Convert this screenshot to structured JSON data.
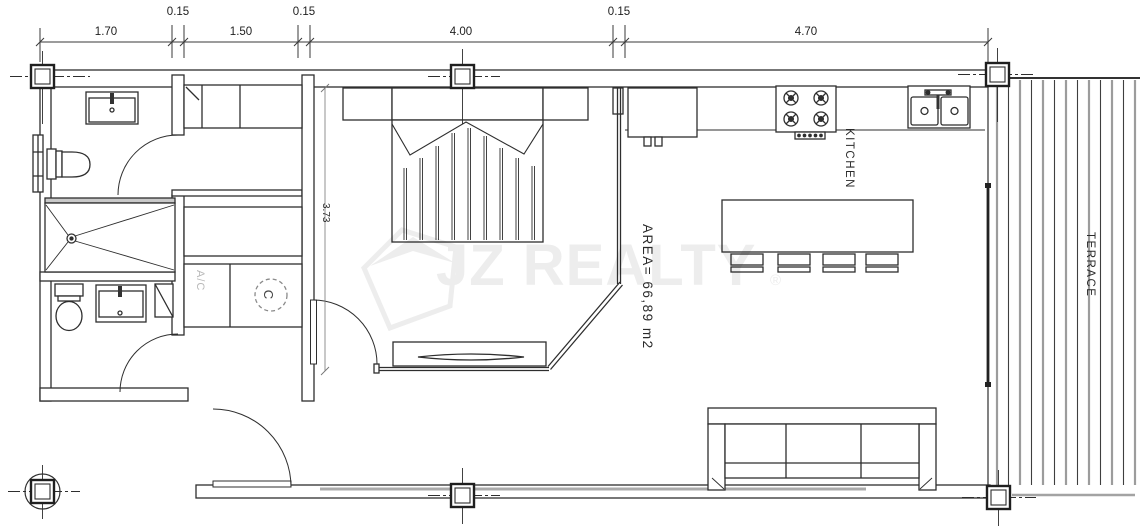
{
  "dims": {
    "top": [
      "1.70",
      "0.15",
      "1.50",
      "0.15",
      "4.00",
      "0.15",
      "4.70"
    ],
    "side": "3.73"
  },
  "labels": {
    "kitchen": "KITCHEN",
    "terrace": "TERRACE",
    "area": "AREA= 66,89  m2",
    "ac": "A/C",
    "heater": "C"
  },
  "watermark": {
    "text": "JZ REALTY",
    "reg": "®"
  },
  "colors": {
    "line": "#2e2e2e",
    "deck": "#9c9c9c",
    "watermark": "#ededed"
  }
}
